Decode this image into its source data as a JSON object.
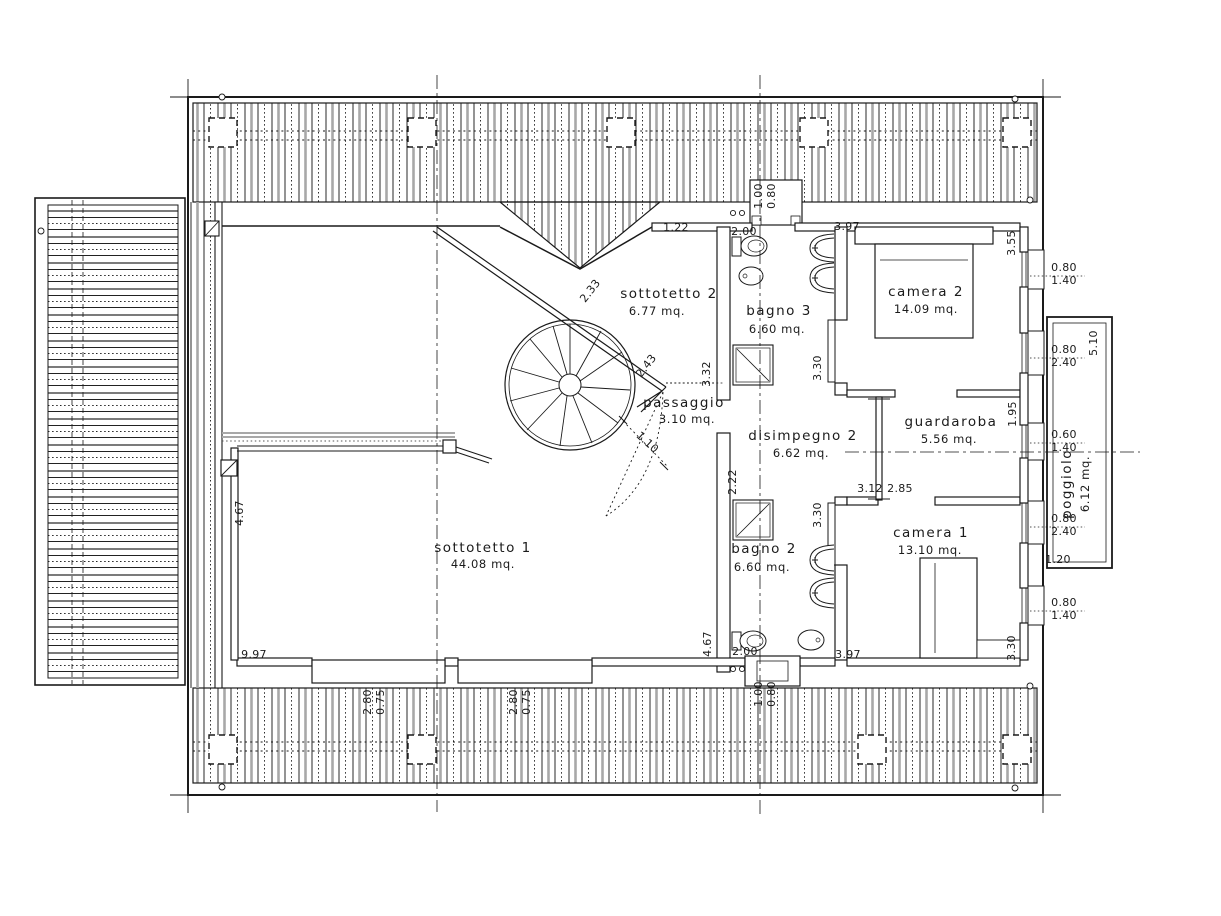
{
  "drawing": {
    "type": "floor-plan",
    "units": "mq.",
    "colors": {
      "line": "#1a1a1a",
      "hatch_gray": "#a8a8a8",
      "background": "#ffffff"
    },
    "rooms": [
      {
        "name": "sottotetto 1",
        "area": "44.08 mq.",
        "x": 483,
        "y": 552,
        "ax": 483,
        "ay": 568,
        "rot": 0
      },
      {
        "name": "sottotetto 2",
        "area": "6.77 mq.",
        "x": 669,
        "y": 298,
        "ax": 657,
        "ay": 315,
        "rot": 0
      },
      {
        "name": "bagno 3",
        "area": "6.60 mq.",
        "x": 779,
        "y": 315,
        "ax": 777,
        "ay": 333,
        "rot": 0
      },
      {
        "name": "camera 2",
        "area": "14.09 mq.",
        "x": 926,
        "y": 296,
        "ax": 926,
        "ay": 313,
        "rot": 0
      },
      {
        "name": "passaggio",
        "area": "3.10 mq.",
        "x": 684,
        "y": 407,
        "ax": 687,
        "ay": 423,
        "rot": 0
      },
      {
        "name": "disimpegno 2",
        "area": "6.62 mq.",
        "x": 803,
        "y": 440,
        "ax": 801,
        "ay": 457,
        "rot": 0
      },
      {
        "name": "guardaroba",
        "area": "5.56 mq.",
        "x": 951,
        "y": 426,
        "ax": 949,
        "ay": 443,
        "rot": 0
      },
      {
        "name": "bagno 2",
        "area": "6.60 mq.",
        "x": 764,
        "y": 553,
        "ax": 762,
        "ay": 571,
        "rot": 0
      },
      {
        "name": "camera 1",
        "area": "13.10 mq.",
        "x": 931,
        "y": 537,
        "ax": 930,
        "ay": 554,
        "rot": 0
      },
      {
        "name": "poggiolo",
        "area": "6.12 mq.",
        "x": 1071,
        "y": 484,
        "ax": 1089,
        "ay": 484,
        "rot": -90
      }
    ],
    "dimensions": [
      {
        "text": "1.22",
        "x": 676,
        "y": 231,
        "rot": 0
      },
      {
        "text": "2.00",
        "x": 744,
        "y": 235,
        "rot": 0
      },
      {
        "text": "3.97",
        "x": 847,
        "y": 230,
        "rot": 0
      },
      {
        "text": "3.55",
        "x": 1015,
        "y": 243,
        "rot": -90
      },
      {
        "text": "0.80",
        "x": 1064,
        "y": 271,
        "rot": 0
      },
      {
        "text": "1.40",
        "x": 1064,
        "y": 284,
        "rot": 0
      },
      {
        "text": "5.10",
        "x": 1097,
        "y": 343,
        "rot": -90
      },
      {
        "text": "0.80",
        "x": 1064,
        "y": 353,
        "rot": 0
      },
      {
        "text": "2.40",
        "x": 1064,
        "y": 366,
        "rot": 0
      },
      {
        "text": "2.33",
        "x": 593,
        "y": 293,
        "rot": -52
      },
      {
        "text": "2.43",
        "x": 649,
        "y": 368,
        "rot": -52
      },
      {
        "text": "3.32",
        "x": 710,
        "y": 374,
        "rot": -90
      },
      {
        "text": "3.30",
        "x": 821,
        "y": 368,
        "rot": -90
      },
      {
        "text": "1.95",
        "x": 1016,
        "y": 414,
        "rot": -90
      },
      {
        "text": "0.60",
        "x": 1064,
        "y": 438,
        "rot": 0
      },
      {
        "text": "1.40",
        "x": 1064,
        "y": 451,
        "rot": 0
      },
      {
        "text": "1.10",
        "x": 645,
        "y": 445,
        "rot": 42
      },
      {
        "text": "2.22",
        "x": 736,
        "y": 482,
        "rot": -90
      },
      {
        "text": "3.12",
        "x": 870,
        "y": 492,
        "rot": 0
      },
      {
        "text": "2.85",
        "x": 900,
        "y": 492,
        "rot": 0
      },
      {
        "text": "3.30",
        "x": 821,
        "y": 515,
        "rot": -90
      },
      {
        "text": "0.80",
        "x": 1064,
        "y": 522,
        "rot": 0
      },
      {
        "text": "2.40",
        "x": 1064,
        "y": 535,
        "rot": 0
      },
      {
        "text": "1.20",
        "x": 1058,
        "y": 563,
        "rot": 0
      },
      {
        "text": "0.80",
        "x": 1064,
        "y": 606,
        "rot": 0
      },
      {
        "text": "1.40",
        "x": 1064,
        "y": 619,
        "rot": 0
      },
      {
        "text": "4.67",
        "x": 243,
        "y": 513,
        "rot": -90
      },
      {
        "text": "4.67",
        "x": 711,
        "y": 644,
        "rot": -90
      },
      {
        "text": "3.30",
        "x": 1015,
        "y": 648,
        "rot": -90
      },
      {
        "text": "9.97",
        "x": 254,
        "y": 658,
        "rot": 0
      },
      {
        "text": "2.00",
        "x": 745,
        "y": 655,
        "rot": 0
      },
      {
        "text": "3.97",
        "x": 848,
        "y": 658,
        "rot": 0
      },
      {
        "text": "2.80",
        "x": 371,
        "y": 702,
        "rot": -90
      },
      {
        "text": "0.75",
        "x": 384,
        "y": 702,
        "rot": -90
      },
      {
        "text": "2.80",
        "x": 517,
        "y": 702,
        "rot": -90
      },
      {
        "text": "0.75",
        "x": 530,
        "y": 702,
        "rot": -90
      },
      {
        "text": "1.00",
        "x": 762,
        "y": 196,
        "rot": -90
      },
      {
        "text": "0.80",
        "x": 775,
        "y": 196,
        "rot": -90
      },
      {
        "text": "1.00",
        "x": 762,
        "y": 694,
        "rot": -90
      },
      {
        "text": "0.80",
        "x": 775,
        "y": 694,
        "rot": -90
      }
    ]
  }
}
